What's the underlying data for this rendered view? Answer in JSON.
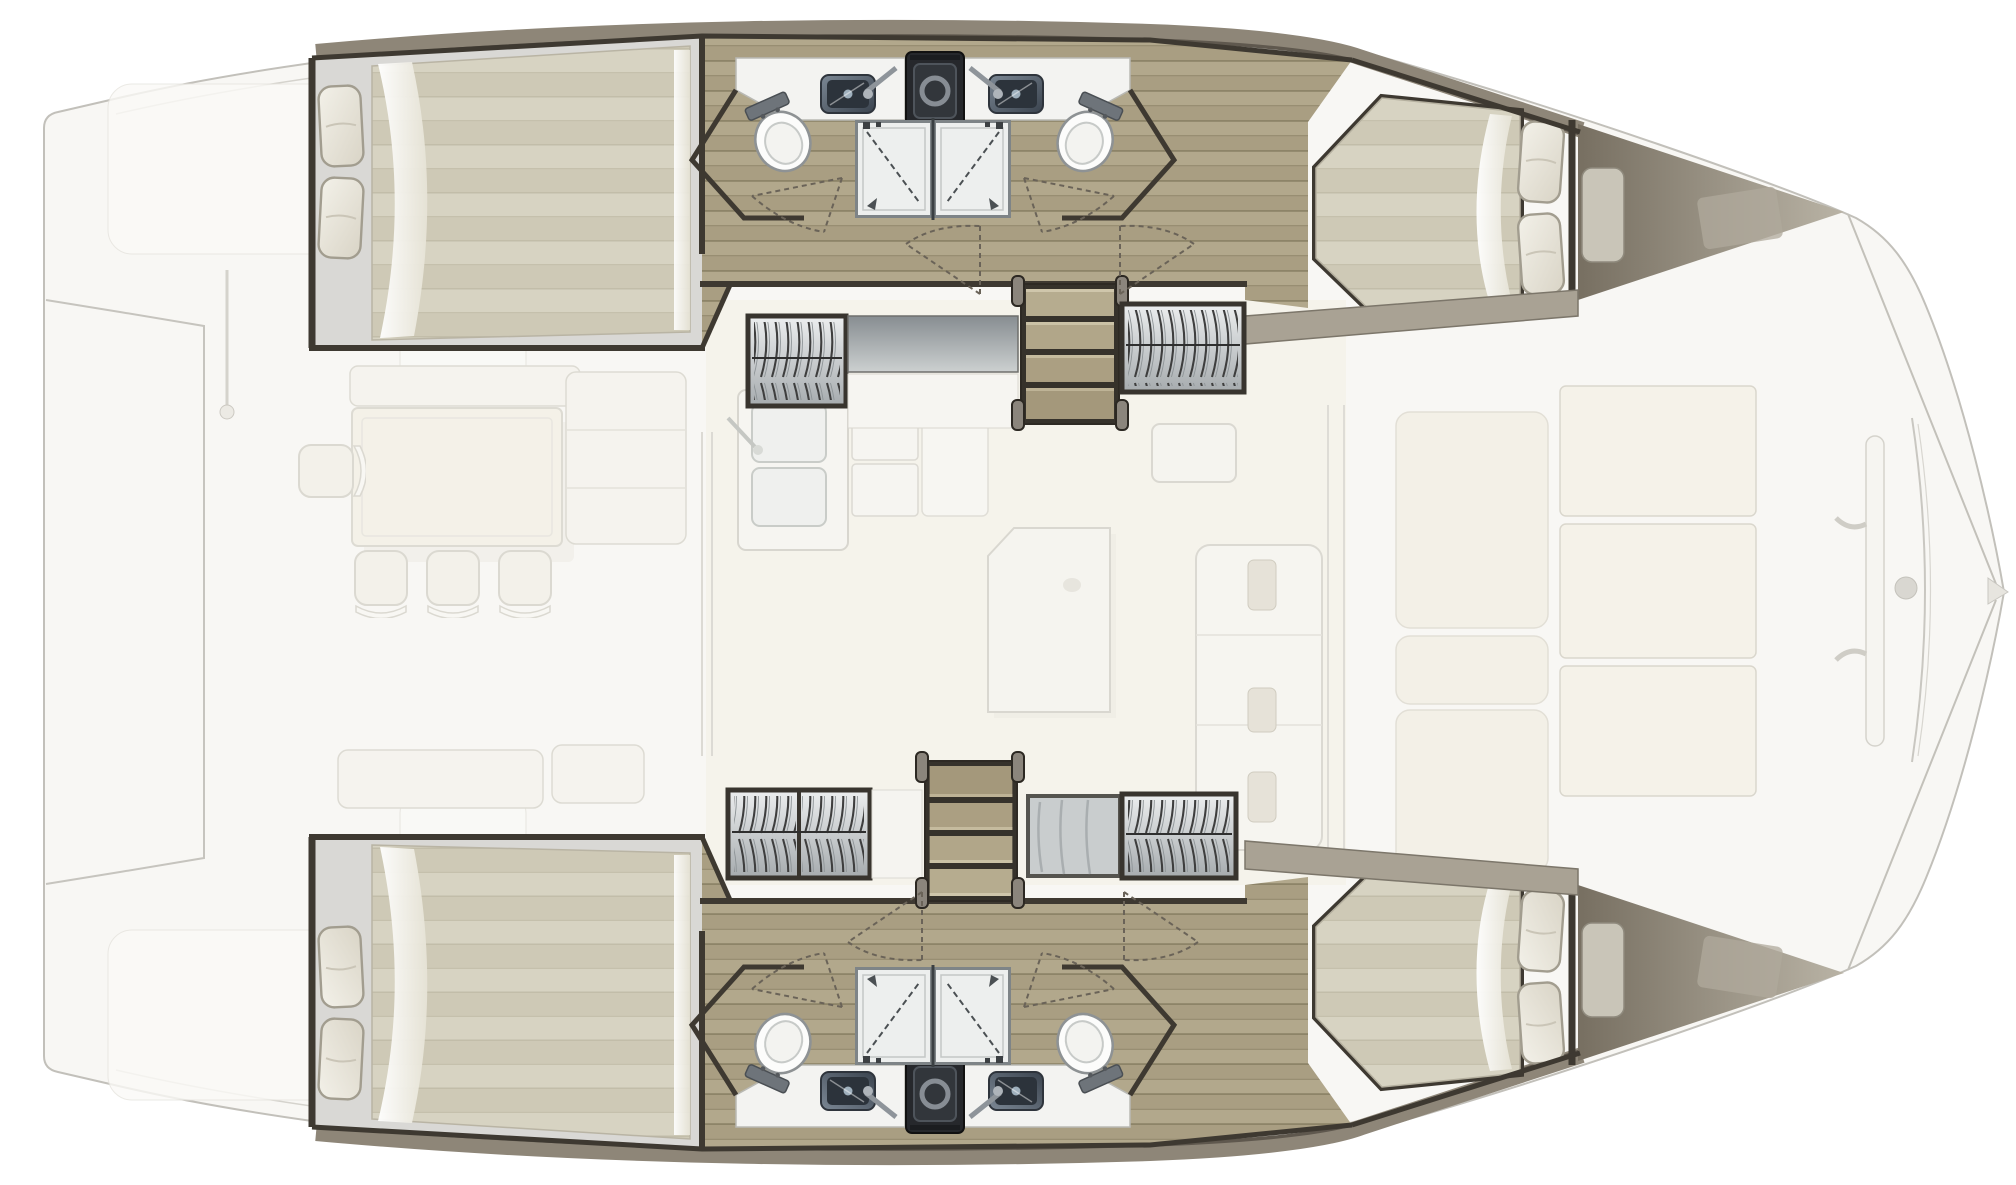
{
  "diagram": {
    "type": "yacht-floorplan",
    "vessel": "sailing-catamaran",
    "layout": "4-cabin / 4-shower owner layout, top view",
    "rooms": {
      "port_hull": [
        "aft-double-cabin",
        "bathroom-with-twin-showers",
        "companionway-stairs",
        "hanging-lockers",
        "forward-double-cabin",
        "forepeak-berth"
      ],
      "starboard_hull": [
        "aft-double-cabin",
        "bathroom-with-twin-showers",
        "companionway-stairs",
        "hanging-lockers",
        "forward-double-cabin",
        "forepeak-berth"
      ],
      "bridgedeck": [
        "aft-cockpit-dining",
        "saloon-galley",
        "saloon-table",
        "saloon-sofa",
        "foredeck-trampoline"
      ]
    },
    "fixture_counts": {
      "double-beds": 4,
      "forepeak-berths": 2,
      "pillows": 8,
      "toilets": 4,
      "washbasins": 4,
      "shower-cabins": 4,
      "hanging-lockers": 6,
      "companionway-stairs": 2,
      "galley-sinks": 2,
      "cockpit-chairs": 4,
      "trampoline-panels": 3,
      "door-swing-arcs": 8
    },
    "icons": [
      "bed-icon",
      "pillow-icon",
      "toilet-icon",
      "sink-icon",
      "shower-icon",
      "hanging-clothes-icon",
      "stairs-icon",
      "door-swing-icon",
      "table-icon",
      "chair-icon",
      "sofa-icon",
      "trampoline-icon",
      "appliance-icon"
    ]
  },
  "colors": {
    "bg": "#ffffff",
    "ghost_fill": "#f8f7f4",
    "ghost_line": "#c2c0ba",
    "ghost_line_soft": "#dcdad4",
    "ghost_white": "#fbfaf7",
    "ivory": "#f4f1e8",
    "saloon_floor": "#f3f1e7",
    "hull_frame": "#3e3931",
    "gunwale": "#8e8678",
    "gunwale_edge": "#5f584e",
    "deck_band": "#a9a294",
    "wood_base": "#b2a88c",
    "wood_dark": "#a99e82",
    "wood_line": "#8d8468",
    "mattress": "#d7d3c2",
    "mattress_band": "#cec9b6",
    "grey_head": "#d9d8d5",
    "pillow_hi": "#f3f1e9",
    "pillow_lo": "#d9d4c6",
    "sheet_hi": "#ffffff",
    "sheet_lo": "#e6e3d6",
    "vanity": "#f3f3f1",
    "steel_hi": "#7b8794",
    "steel_lo": "#3a434e",
    "basin": "#2c333b",
    "appliance": "#26282c",
    "appliance_ring": "#878d94",
    "toilet": "#fcfcfb",
    "toilet_line": "#8e9294",
    "shower_floor": "#edefee",
    "shower_line": "#7e8487",
    "glass_dash": "#4b5053",
    "ward_hi": "#eceeef",
    "ward_lo": "#a6abae",
    "clothes_line": "#3e3e3e",
    "bench_hi": "#878d91",
    "bench_lo": "#ccd0d0",
    "stair_frame": "#36322b",
    "stair_tread": "#b6ac8f",
    "post": "#8b857c",
    "forepeak_dark": "#776f61",
    "forepeak_light": "#b9b3a5",
    "cushion": "#c9c5b8",
    "arc_dash": "#6a6358"
  }
}
